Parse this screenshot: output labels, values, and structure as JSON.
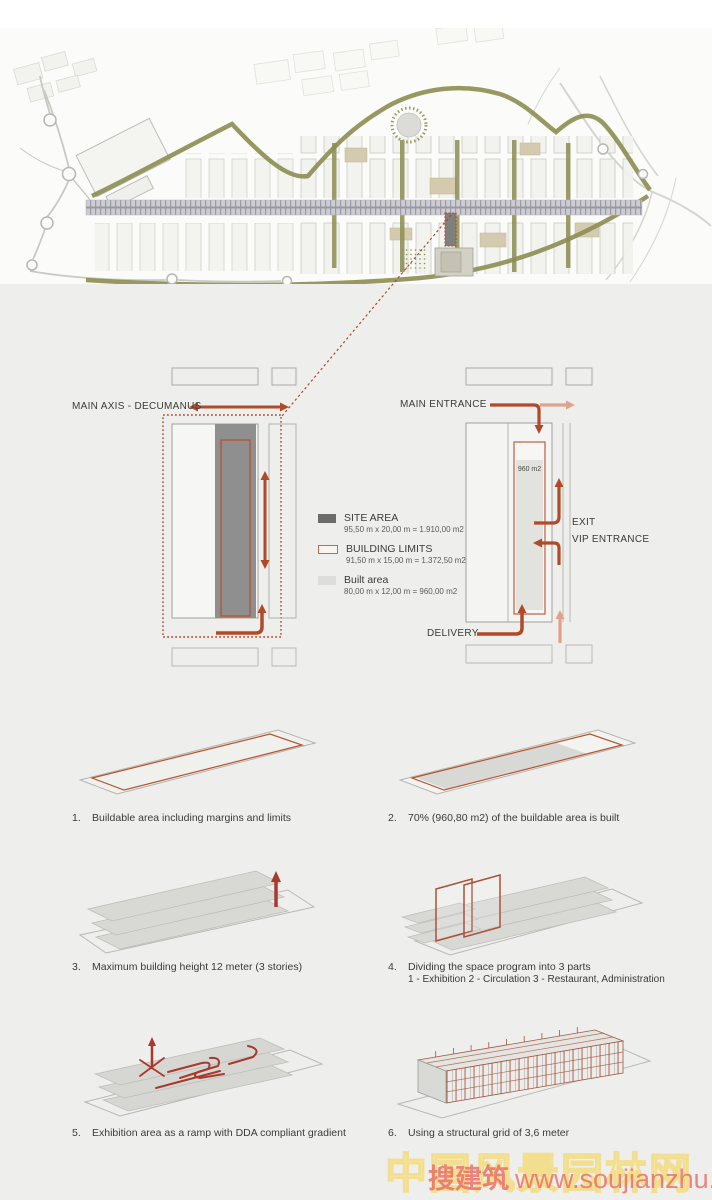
{
  "left_diagram": {
    "axis_label": "MAIN AXIS - DECUMANUS"
  },
  "right_diagram": {
    "main_entrance": "MAIN ENTRANCE",
    "exit": "EXIT",
    "vip_entrance": "VIP ENTRANCE",
    "delivery": "DELIVERY",
    "built_label": "960 m2"
  },
  "legend": {
    "items": [
      {
        "label": "SITE AREA",
        "detail": "95,50 m x 20,00 m = 1.910,00 m2"
      },
      {
        "label": "BUILDING LIMITS",
        "detail": "91,50 m x 15,00 m = 1.372,50 m2"
      },
      {
        "label": "Built area",
        "detail": "80,00 m x 12,00 m = 960,00 m2"
      }
    ]
  },
  "steps": [
    {
      "num": "1.",
      "text": "Buildable area including margins and limits"
    },
    {
      "num": "2.",
      "text": "70% (960,80 m2) of the buildable area is built"
    },
    {
      "num": "3.",
      "text": "Maximum building height 12 meter (3 stories)"
    },
    {
      "num": "4.",
      "text": "Dividing the space program into 3 parts",
      "text2": "1 - Exhibition  2 - Circulation  3 - Restaurant, Administration"
    },
    {
      "num": "5.",
      "text": "Exhibition area as a ramp with DDA compliant gradient"
    },
    {
      "num": "6.",
      "text": "Using a structural grid of 3,6 meter"
    }
  ],
  "watermark": {
    "cn": "搜建筑",
    "url": "www.soujianzhu.cn",
    "bg_text": "中国风景园林网"
  },
  "colors": {
    "accent": "#b14a28",
    "accent_light": "#dfa28c",
    "site_gray": "#8f8f8f",
    "legend_dark": "#6c6c6c",
    "built_gray": "#dddddb",
    "olive": "#8d8d52"
  }
}
